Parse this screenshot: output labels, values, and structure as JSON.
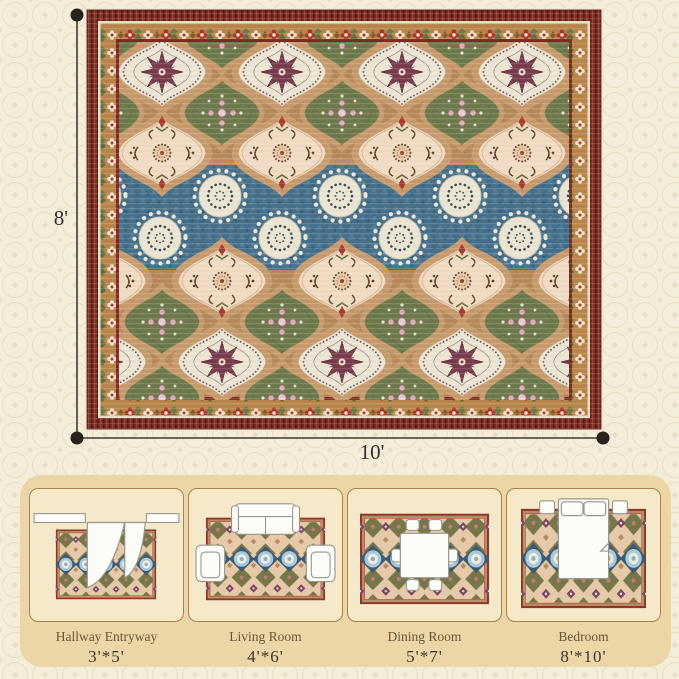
{
  "rug": {
    "height_label": "8'",
    "width_label": "10'"
  },
  "rooms": [
    {
      "name": "Hallway Entryway",
      "size": "3'*5'"
    },
    {
      "name": "Living Room",
      "size": "4'*6'"
    },
    {
      "name": "Dining Room",
      "size": "5'*7'"
    },
    {
      "name": "Bedroom",
      "size": "8'*10'"
    }
  ],
  "colors": {
    "background": "#f4edda",
    "background_lattice": "#e8ddc3",
    "panel": "#ecd6a8",
    "card": "#f6e9ca",
    "card_border": "#a5854f",
    "rug_border_maroon": "#7c2b23",
    "rug_gold_band": "#b9854a",
    "rug_field_tan": "#b5895c",
    "rug_green": "#6d7a4c",
    "rug_blue_band": "#44708d",
    "rug_ivory": "#ece6d2",
    "rug_blush": "#f1dbc4",
    "rug_plum": "#6f5570",
    "rug_star_maroon": "#7b3a4d",
    "dimension_line": "#3f3b35",
    "label_text": "#33302b",
    "room_name_text": "#675738",
    "room_size_text": "#3a362f"
  }
}
